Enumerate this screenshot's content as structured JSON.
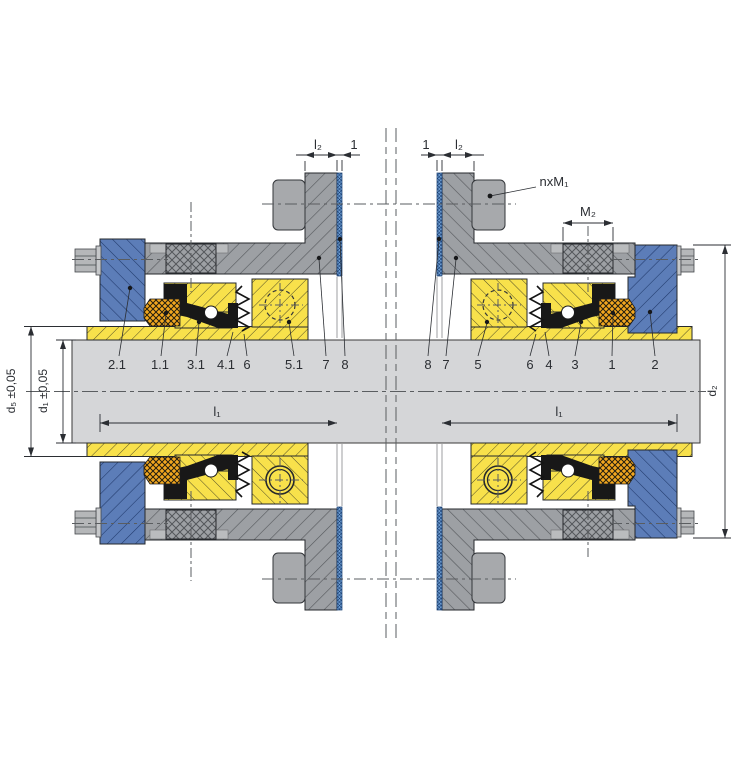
{
  "diagram": {
    "type": "technical-drawing",
    "subject": "Mechanical cartridge seal cross-section (installation drawing)",
    "dimension_labels": {
      "l2_left": "l₂",
      "gasket_left": "1",
      "gasket_right": "1",
      "l2_right": "l₂",
      "bolts": "nxM₁",
      "m2": "M₂",
      "d5": "d₅ ±0,05",
      "d1": "d₁ ±0,05",
      "d2": "d₂",
      "l1_left": "l₁",
      "l1_right": "l₁"
    },
    "part_labels_left": [
      "2.1",
      "1.1",
      "3.1",
      "4.1",
      "6",
      "5.1",
      "7",
      "8"
    ],
    "part_labels_right": [
      "8",
      "7",
      "5",
      "6",
      "4",
      "3",
      "1",
      "2"
    ],
    "colors": {
      "housing_gray": "#9DA0A4",
      "cover_blue": "#5C7DB8",
      "seal_yellow": "#F8E14B",
      "elastomer_black": "#181818",
      "oring_orange": "#F2A71F",
      "gasket_blue": "#6FA0D6",
      "shaft_gray": "#D5D6D8",
      "line": "#2C2F33"
    }
  }
}
